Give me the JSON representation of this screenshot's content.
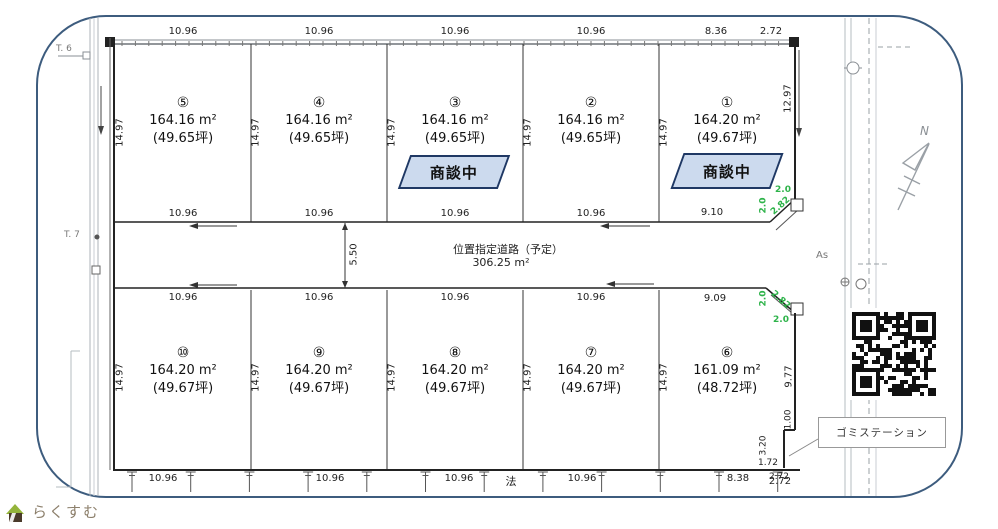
{
  "branding": {
    "logo_text": "らくすむ"
  },
  "compass": {
    "label": "N"
  },
  "road_left": {
    "t6": "T. 6",
    "t7": "T. 7"
  },
  "road_right": {
    "surface_label": "As"
  },
  "plots": [
    {
      "number": "①",
      "area": "164.20 m²",
      "tsubo": "(49.67坪)",
      "status": "商談中"
    },
    {
      "number": "②",
      "area": "164.16 m²",
      "tsubo": "(49.65坪)"
    },
    {
      "number": "③",
      "area": "164.16 m²",
      "tsubo": "(49.65坪)",
      "status": "商談中"
    },
    {
      "number": "④",
      "area": "164.16 m²",
      "tsubo": "(49.65坪)"
    },
    {
      "number": "⑤",
      "area": "164.16 m²",
      "tsubo": "(49.65坪)"
    },
    {
      "number": "⑥",
      "area": "161.09 m²",
      "tsubo": "(48.72坪)"
    },
    {
      "number": "⑦",
      "area": "164.20 m²",
      "tsubo": "(49.67坪)"
    },
    {
      "number": "⑧",
      "area": "164.20 m²",
      "tsubo": "(49.67坪)"
    },
    {
      "number": "⑨",
      "area": "164.20 m²",
      "tsubo": "(49.67坪)"
    },
    {
      "number": "⑩",
      "area": "164.20 m²",
      "tsubo": "(49.67坪)"
    }
  ],
  "road": {
    "name": "位置指定道路（予定）",
    "area": "306.25 m²",
    "width_label": "5.50"
  },
  "dims": {
    "top": [
      "10.96",
      "10.96",
      "10.96",
      "10.96",
      "8.36",
      "2.72"
    ],
    "side_top_row": [
      "14.97",
      "14.97",
      "14.97",
      "14.97",
      "14.97"
    ],
    "side_bottom_row": [
      "14.97",
      "14.97",
      "14.97",
      "14.97",
      "14.97"
    ],
    "road_upper": [
      "10.96",
      "10.96",
      "10.96",
      "10.96",
      "9.10"
    ],
    "road_lower": [
      "10.96",
      "10.96",
      "10.96",
      "10.96",
      "9.09"
    ],
    "bottom": [
      "10.96",
      "10.96",
      "10.96",
      "10.96",
      "8.38",
      "2.72"
    ],
    "right": {
      "upper": "12.97",
      "lower": "9.77",
      "notch_a": "1.00",
      "notch_b": "3.20",
      "notch_c": "1.72",
      "notch_d": "2.72"
    },
    "corner_top": [
      "2.0",
      "2.0",
      "2.82"
    ],
    "corner_bottom": [
      "2.0",
      "2.0",
      "2.82"
    ],
    "boundary_note": "法"
  },
  "garbage_station": {
    "label": "ゴミステーション"
  }
}
